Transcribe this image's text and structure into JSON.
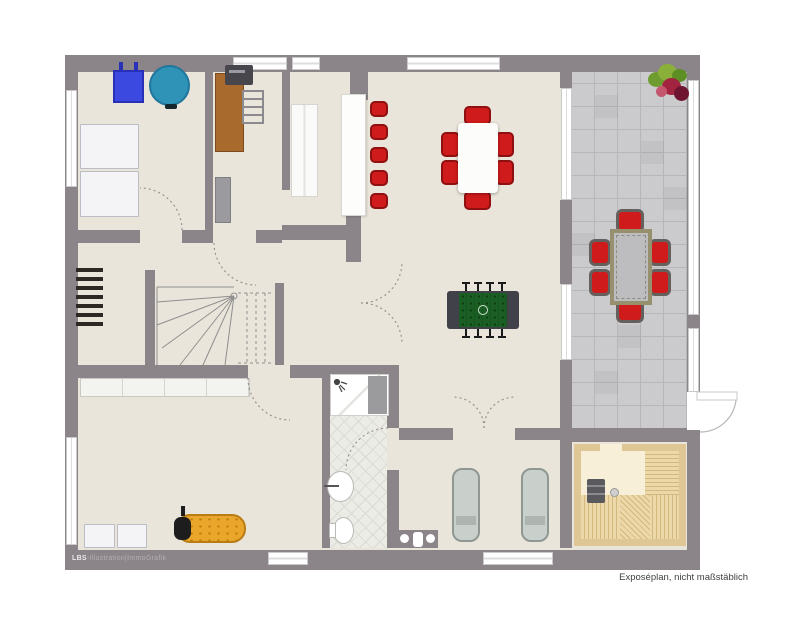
{
  "captions": {
    "credit_bold": "LBS",
    "credit_rest": "-Illustration|ImmoGrafik",
    "disclaimer": "Exposéplan, nicht maßstäblich"
  },
  "colors": {
    "wall": "#8b8488",
    "floor": "#eae5da",
    "tile": "#cbcbcd",
    "tline": "#b7b7ba",
    "sauna1": "#dfc795",
    "sauna2": "#f8efd8",
    "bench1": "#ecd8a8",
    "bench2": "#d3b87f",
    "red": "#cf1b1b",
    "red2": "#8e1010",
    "green": "#1b5e23",
    "green2": "#175420",
    "blue": "#3c49e0",
    "blue2": "#2730b6",
    "teal": "#2e93b6",
    "teal2": "#20769c",
    "orange": "#e9a62a",
    "orange2": "#b97d14",
    "lng1": "#c9cfcb",
    "lng2": "#8f9792",
    "wood": "#a96b2d",
    "wood2": "#7d4b1d",
    "winb": "#c9c9c9",
    "bath1": "#ecece7",
    "bath2": "#dadad2",
    "cred1": "#eceaec",
    "cred2": "#b5aeb2",
    "disc": "#3f3f3f"
  },
  "inventory": {
    "fitness_room": [
      "exercise-box",
      "gym-ball",
      "storage-boxes (2)"
    ],
    "office_nook": [
      "desk",
      "printer",
      "rack-chair",
      "cabinet"
    ],
    "kitchen": [
      "kitchen-counter",
      "bar-counter",
      "bar-stools (5)"
    ],
    "dining_living": [
      "dining-table",
      "dining-chairs (6)",
      "foosball-table"
    ],
    "hallway": [
      "wine-rack",
      "winder-stairs",
      "sideboard"
    ],
    "bathroom": [
      "shower",
      "sink",
      "toilet"
    ],
    "relax_room": [
      "loungers (2)",
      "wall-fixture"
    ],
    "sauna": [
      "sauna-benches",
      "sauna-heater"
    ],
    "terrace": [
      "patio-table",
      "patio-chairs (6)",
      "flower-pot"
    ],
    "bottom_room": [
      "massage-lounger",
      "storage-boxes (2)"
    ]
  }
}
